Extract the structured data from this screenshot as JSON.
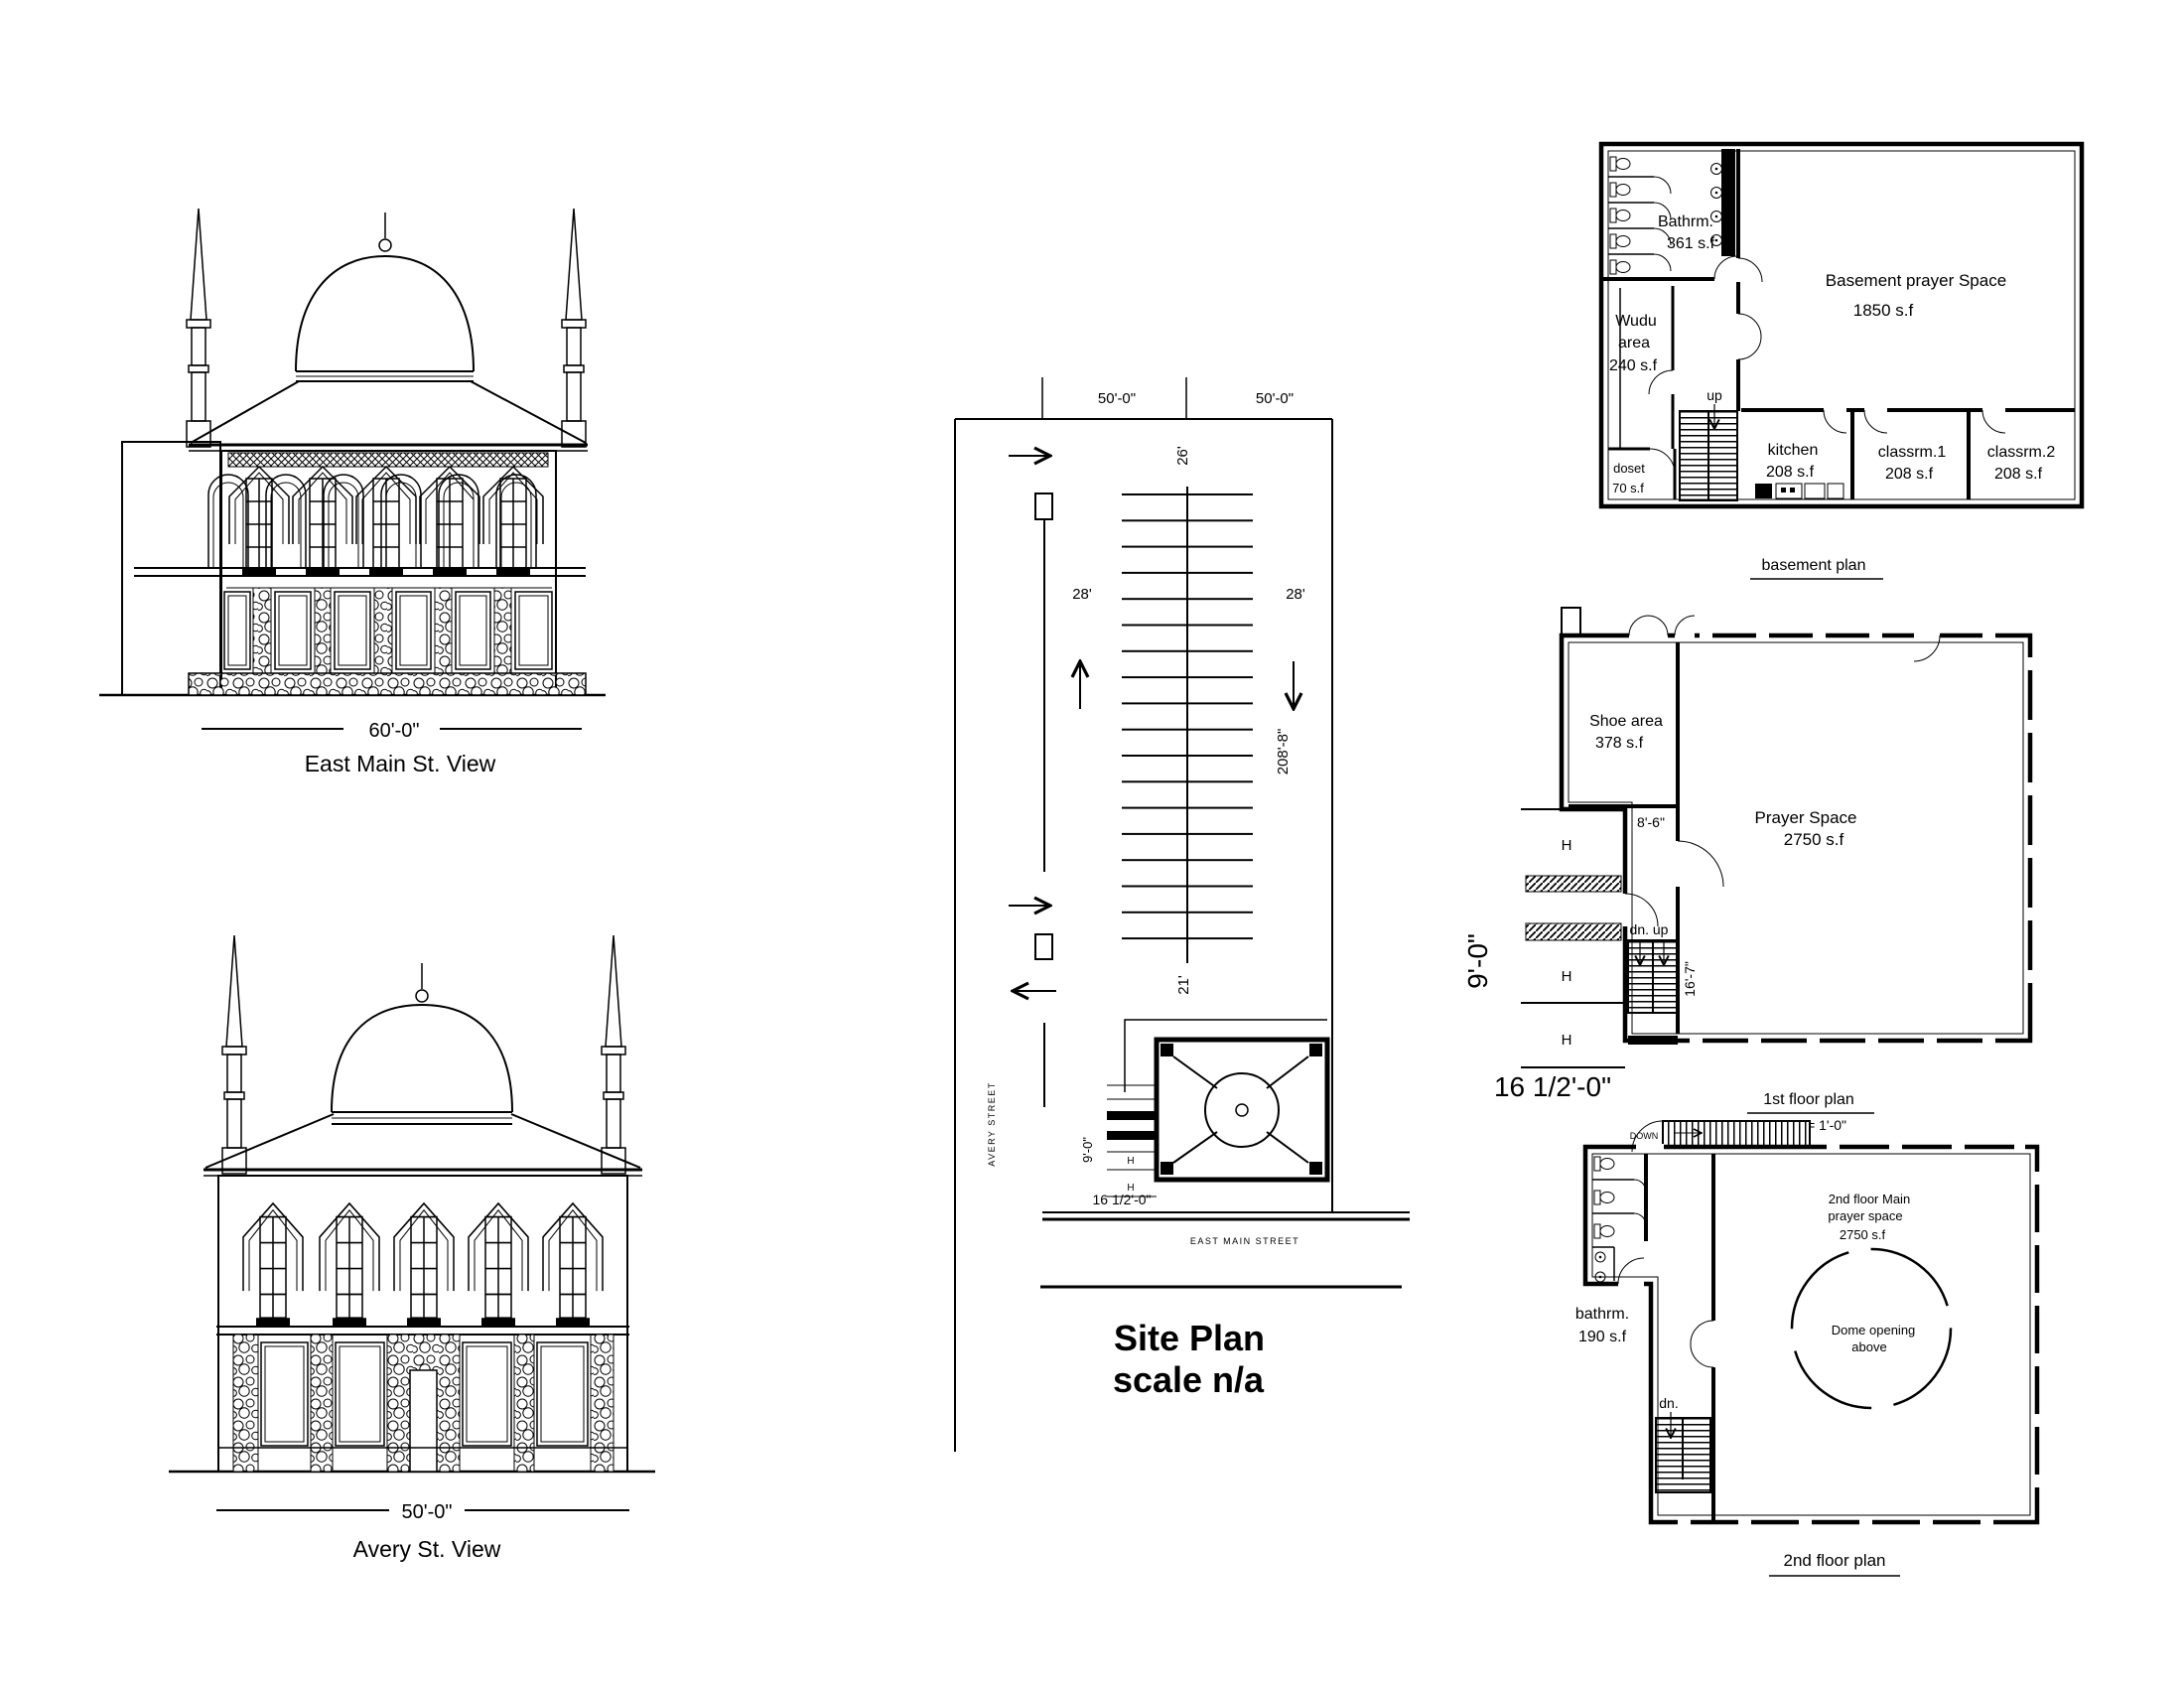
{
  "sheet": {
    "elevations": {
      "east_main": {
        "dimension": "60'-0\"",
        "label": "East Main St. View"
      },
      "avery": {
        "dimension": "50'-0\"",
        "label": "Avery St. View"
      }
    },
    "site_plan": {
      "title": "Site Plan",
      "scale": "scale n/a",
      "dim_top_left": "50'-0\"",
      "dim_top_right": "50'-0\"",
      "dim_aisle": "26'",
      "dim_stall_left": "28'",
      "dim_stall_right": "28'",
      "dim_depth": "208'-8\"",
      "dim_drive": "21'",
      "dim_entry_depth": "9'-0\"",
      "dim_entry_width": "16 1/2'-0\"",
      "street_west": "AVERY STREET",
      "street_south": "EAST MAIN STREET",
      "handicap_1": "H",
      "handicap_2": "H"
    },
    "basement_plan": {
      "title": "basement plan",
      "bathroom_label": "Bathrm.",
      "bathroom_area": "361 s.f",
      "prayer_label": "Basement prayer Space",
      "prayer_area": "1850 s.f",
      "wudu_label_1": "Wudu",
      "wudu_label_2": "area",
      "wudu_area": "240 s.f",
      "stair_label": "up",
      "closet_label": "doset",
      "closet_area": "70 s.f",
      "kitchen_label": "kitchen",
      "kitchen_area": "208 s.f",
      "classroom1_label": "classrm.1",
      "classroom1_area": "208 s.f",
      "classroom2_label": "classrm.2",
      "classroom2_area": "208 s.f"
    },
    "first_floor_plan": {
      "title": "1st floor plan",
      "scale_note": "3/32\" = 1'-0\"",
      "shoe_label": "Shoe area",
      "shoe_area": "378 s.f",
      "dim_hall": "8'-6\"",
      "prayer_label": "Prayer Space",
      "prayer_area": "2750 s.f",
      "stair_label": "dn. up",
      "dim_stair": "16'-7\"",
      "handicap_1": "H",
      "handicap_2": "H",
      "handicap_3": "H",
      "dim_entry_depth": "9'-0\"",
      "dim_entry_width": "16 1/2'-0\""
    },
    "second_floor_plan": {
      "title": "2nd floor plan",
      "stair_top_label": "DOWN",
      "bathroom_label": "bathrm.",
      "bathroom_area": "190 s.f",
      "prayer_label_1": "2nd floor Main",
      "prayer_label_2": "prayer space",
      "prayer_area": "2750 s.f",
      "dome_label_1": "Dome opening",
      "dome_label_2": "above",
      "stair_label": "dn."
    }
  }
}
